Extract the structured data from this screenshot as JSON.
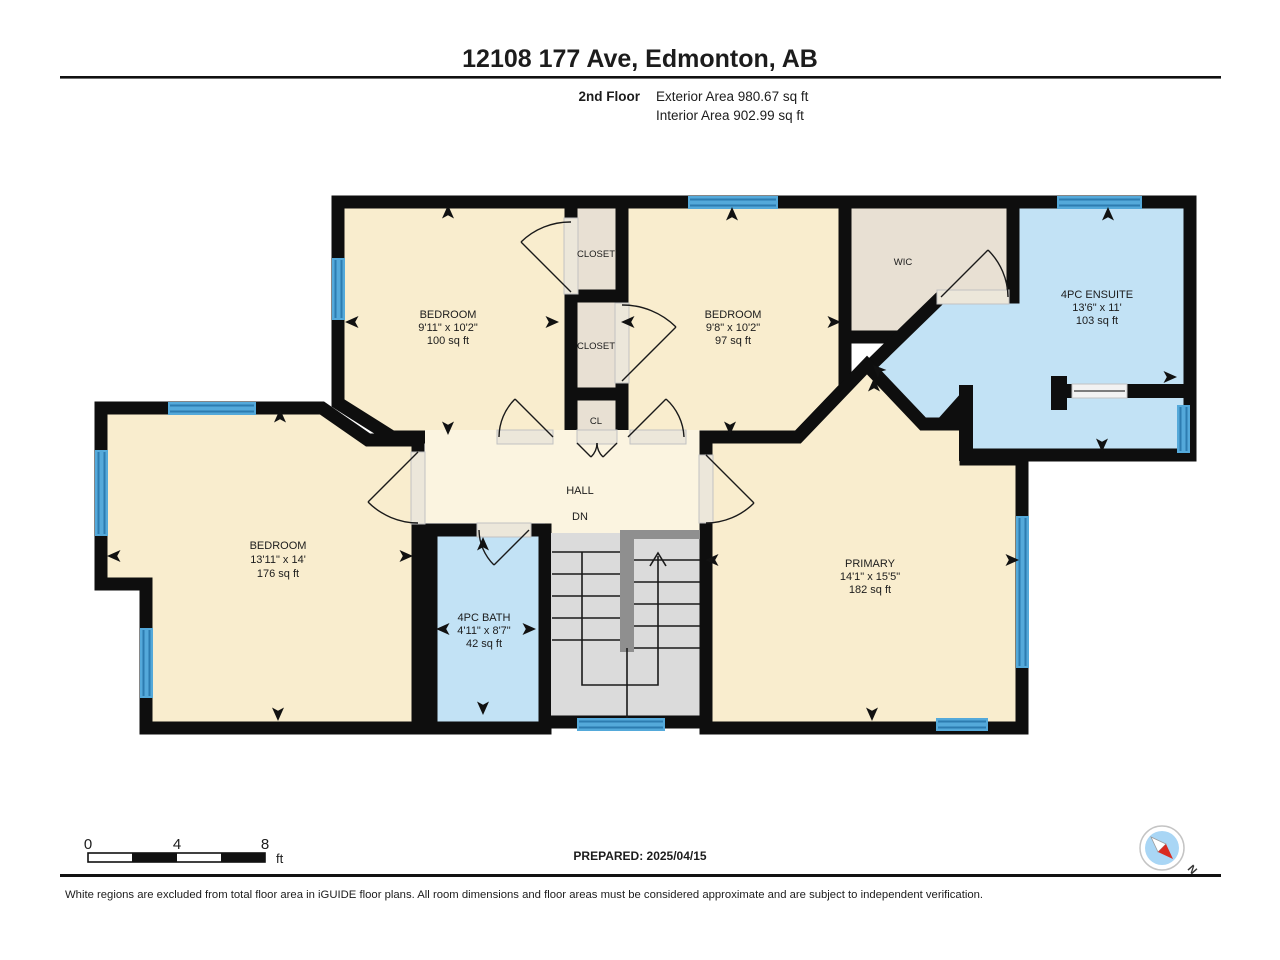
{
  "header": {
    "title": "12108 177 Ave, Edmonton, AB",
    "floor_label": "2nd Floor",
    "exterior_area": "Exterior Area 980.67 sq ft",
    "interior_area": "Interior Area 902.99 sq ft"
  },
  "rooms": {
    "bedroom_top_left": {
      "name": "BEDROOM",
      "dims": "9'11\" x 10'2\"",
      "area": "100 sq ft"
    },
    "bedroom_top_right": {
      "name": "BEDROOM",
      "dims": "9'8\" x 10'2\"",
      "area": "97 sq ft"
    },
    "bedroom_left": {
      "name": "BEDROOM",
      "dims": "13'11\" x 14'",
      "area": "176 sq ft"
    },
    "primary": {
      "name": "PRIMARY",
      "dims": "14'1\" x 15'5\"",
      "area": "182 sq ft"
    },
    "ensuite": {
      "name": "4PC ENSUITE",
      "dims": "13'6\" x 11'",
      "area": "103 sq ft"
    },
    "bath": {
      "name": "4PC BATH",
      "dims": "4'11\" x 8'7\"",
      "area": "42 sq ft"
    },
    "wic": {
      "name": "WIC"
    },
    "closet_upper": {
      "name": "CLOSET"
    },
    "closet_lower": {
      "name": "CLOSET"
    },
    "closet_small": {
      "name": "CL"
    },
    "hall": {
      "name": "HALL"
    },
    "stairs": {
      "label": "DN"
    }
  },
  "scale_bar": {
    "tick_0": "0",
    "tick_4": "4",
    "tick_8": "8",
    "unit": "ft"
  },
  "footer": {
    "prepared": "PREPARED: 2025/04/15",
    "disclaimer": "White regions are excluded from total floor area in iGUIDE floor plans. All room dimensions and floor areas must be considered approximate and are subject to independent verification."
  },
  "compass": {
    "north_label": "N"
  },
  "colors": {
    "wall": "#0e0e0e",
    "room_fill": "#f9edce",
    "hall_fill": "#fbf4e0",
    "wet_room_fill": "#c2e2f5",
    "closet_fill": "#e8e0d3",
    "stairs_fill": "#dbdbdb",
    "railing": "#8f8f8f",
    "window_blue": "#54a9da",
    "compass_red": "#d92b21",
    "compass_blue": "#a9d6f5"
  }
}
